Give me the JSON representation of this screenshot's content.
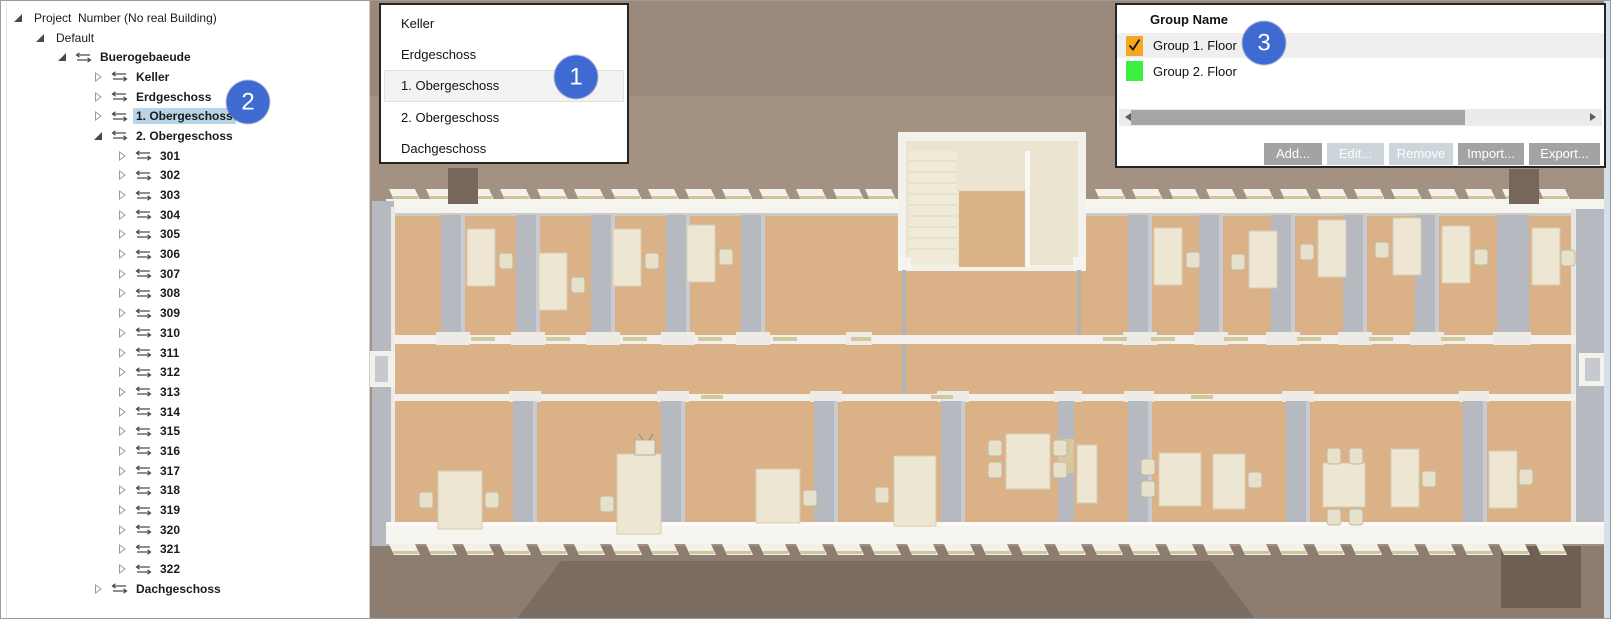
{
  "tree_panel": {
    "items": [
      {
        "label": "Project  Number (No real Building)",
        "level": 0,
        "expander": "expanded",
        "swap_icon": false,
        "bold": false,
        "selected": false
      },
      {
        "label": "Default",
        "level": 1,
        "expander": "expanded",
        "swap_icon": false,
        "bold": false,
        "selected": false
      },
      {
        "label": "Buerogebaeude",
        "level": 2,
        "expander": "expanded",
        "swap_icon": true,
        "bold": true,
        "selected": false
      },
      {
        "label": "Keller",
        "level": 3,
        "expander": "collapsed",
        "swap_icon": true,
        "bold": true,
        "selected": false
      },
      {
        "label": "Erdgeschoss",
        "level": 3,
        "expander": "collapsed",
        "swap_icon": true,
        "bold": true,
        "selected": false
      },
      {
        "label": "1. Obergeschoss",
        "level": 3,
        "expander": "collapsed",
        "swap_icon": true,
        "bold": true,
        "selected": true
      },
      {
        "label": "2. Obergeschoss",
        "level": 3,
        "expander": "expanded",
        "swap_icon": true,
        "bold": true,
        "selected": false
      },
      {
        "label": "301",
        "level": 4,
        "expander": "collapsed",
        "swap_icon": true,
        "bold": true,
        "selected": false
      },
      {
        "label": "302",
        "level": 4,
        "expander": "collapsed",
        "swap_icon": true,
        "bold": true,
        "selected": false
      },
      {
        "label": "303",
        "level": 4,
        "expander": "collapsed",
        "swap_icon": true,
        "bold": true,
        "selected": false
      },
      {
        "label": "304",
        "level": 4,
        "expander": "collapsed",
        "swap_icon": true,
        "bold": true,
        "selected": false
      },
      {
        "label": "305",
        "level": 4,
        "expander": "collapsed",
        "swap_icon": true,
        "bold": true,
        "selected": false
      },
      {
        "label": "306",
        "level": 4,
        "expander": "collapsed",
        "swap_icon": true,
        "bold": true,
        "selected": false
      },
      {
        "label": "307",
        "level": 4,
        "expander": "collapsed",
        "swap_icon": true,
        "bold": true,
        "selected": false
      },
      {
        "label": "308",
        "level": 4,
        "expander": "collapsed",
        "swap_icon": true,
        "bold": true,
        "selected": false
      },
      {
        "label": "309",
        "level": 4,
        "expander": "collapsed",
        "swap_icon": true,
        "bold": true,
        "selected": false
      },
      {
        "label": "310",
        "level": 4,
        "expander": "collapsed",
        "swap_icon": true,
        "bold": true,
        "selected": false
      },
      {
        "label": "311",
        "level": 4,
        "expander": "collapsed",
        "swap_icon": true,
        "bold": true,
        "selected": false
      },
      {
        "label": "312",
        "level": 4,
        "expander": "collapsed",
        "swap_icon": true,
        "bold": true,
        "selected": false
      },
      {
        "label": "313",
        "level": 4,
        "expander": "collapsed",
        "swap_icon": true,
        "bold": true,
        "selected": false
      },
      {
        "label": "314",
        "level": 4,
        "expander": "collapsed",
        "swap_icon": true,
        "bold": true,
        "selected": false
      },
      {
        "label": "315",
        "level": 4,
        "expander": "collapsed",
        "swap_icon": true,
        "bold": true,
        "selected": false
      },
      {
        "label": "316",
        "level": 4,
        "expander": "collapsed",
        "swap_icon": true,
        "bold": true,
        "selected": false
      },
      {
        "label": "317",
        "level": 4,
        "expander": "collapsed",
        "swap_icon": true,
        "bold": true,
        "selected": false
      },
      {
        "label": "318",
        "level": 4,
        "expander": "collapsed",
        "swap_icon": true,
        "bold": true,
        "selected": false
      },
      {
        "label": "319",
        "level": 4,
        "expander": "collapsed",
        "swap_icon": true,
        "bold": true,
        "selected": false
      },
      {
        "label": "320",
        "level": 4,
        "expander": "collapsed",
        "swap_icon": true,
        "bold": true,
        "selected": false
      },
      {
        "label": "321",
        "level": 4,
        "expander": "collapsed",
        "swap_icon": true,
        "bold": true,
        "selected": false
      },
      {
        "label": "322",
        "level": 4,
        "expander": "collapsed",
        "swap_icon": true,
        "bold": true,
        "selected": false
      },
      {
        "label": "Dachgeschoss",
        "level": 3,
        "expander": "collapsed",
        "swap_icon": true,
        "bold": true,
        "selected": false
      }
    ]
  },
  "floor_list": {
    "items": [
      {
        "label": "Keller",
        "selected": false
      },
      {
        "label": "Erdgeschoss",
        "selected": false
      },
      {
        "label": "1. Obergeschoss",
        "selected": true
      },
      {
        "label": "2. Obergeschoss",
        "selected": false
      },
      {
        "label": "Dachgeschoss",
        "selected": false
      }
    ]
  },
  "group_panel": {
    "header": "Group Name",
    "rows": [
      {
        "label": "Group 1. Floor",
        "color": "#F5A81F",
        "checked": true,
        "highlighted": true
      },
      {
        "label": "Group 2. Floor",
        "color": "#3DF03D",
        "checked": false,
        "highlighted": false
      }
    ],
    "buttons": [
      {
        "label": "Add...",
        "enabled": true
      },
      {
        "label": "Edit...",
        "enabled": false
      },
      {
        "label": "Remove",
        "enabled": false
      },
      {
        "label": "Import...",
        "enabled": true
      },
      {
        "label": "Export...",
        "enabled": true
      }
    ]
  },
  "callouts": [
    {
      "number": "1",
      "x": 575,
      "y": 76
    },
    {
      "number": "2",
      "x": 247,
      "y": 101
    },
    {
      "number": "3",
      "x": 1263,
      "y": 42
    }
  ],
  "colors": {
    "callout_blue": "#3E6AD2",
    "tree_selection_blue": "#B8D4E6",
    "group1_orange": "#F5A81F",
    "group2_green": "#3DF03D",
    "button_gray": "#A3A3A3",
    "button_disabled_gray": "#CCD5DA",
    "floor_tan": "#DBB287",
    "wall_gray": "#B6B9BF"
  }
}
